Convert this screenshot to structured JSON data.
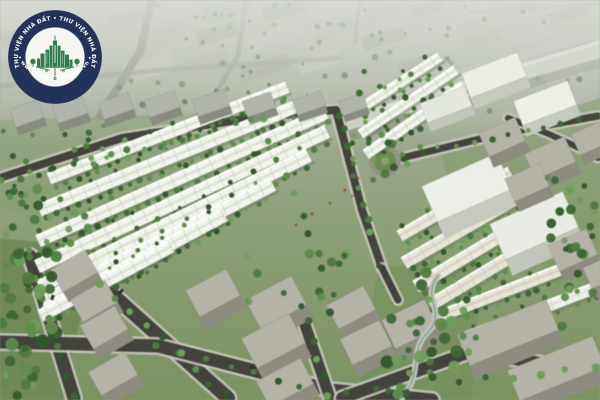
{
  "meta": {
    "width": 600,
    "height": 400,
    "alt": "Aerial 3D rendering of a residential master-planned neighborhood: rows of white townhouses with tree-lined streets, gray apartment blocks in a hazy background, an elevated road top-right, gray villa boxes and dark asphalt roads in the foreground"
  },
  "watermark": {
    "ring_text_top": "THƯ VIỆN NHÀ ĐẤT • THƯ VIỆN NHÀ ĐẤT",
    "ring_text_bottom": "• www.ThuVienNhaDat.vn •",
    "colors": {
      "ring": "#243158",
      "text": "#ffffff",
      "inner_disc": "#f5f6f2",
      "emblem_green": "#2e7b4e"
    }
  },
  "scene": {
    "seed": 1337,
    "palette_notes": {
      "haze_top": "#b4b8ae",
      "grass": "#7b925f",
      "asphalt": "#43423d",
      "sidewalk": "#c8c5b9",
      "townhouse_white": "#f2f4ed",
      "townhouse_beige": "#e8e5d6"
    },
    "palettes": [
      [
        "#3d6833",
        "#4e7b3e",
        "#5f8d4a",
        "#6f9e58",
        "#33572a"
      ],
      [
        "#4a6042",
        "#566f4c",
        "#415939",
        "#5d7850"
      ]
    ],
    "shapes": [
      [
        "rect",
        155,
        2,
        40,
        15,
        "#b6bab0",
        -15
      ],
      [
        "rect",
        203,
        0,
        50,
        17,
        "#a8aca1",
        -15
      ],
      [
        "rect",
        262,
        3,
        44,
        14,
        "#9da295",
        -15
      ],
      [
        "rect",
        316,
        0,
        42,
        15,
        "#b6bab0",
        -15
      ],
      [
        "rect",
        366,
        5,
        38,
        13,
        "#a8aca1",
        -15
      ],
      [
        "rect",
        412,
        2,
        32,
        12,
        "#9da295",
        -15
      ],
      [
        "rect",
        452,
        7,
        40,
        12,
        "#b6bab0",
        -15
      ],
      [
        "rect",
        500,
        3,
        36,
        12,
        "#a8aca1",
        -15
      ],
      [
        "rect",
        548,
        8,
        42,
        12,
        "#9da295",
        -15
      ],
      [
        "rect",
        140,
        28,
        46,
        17,
        "#a8aca1",
        -16
      ],
      [
        "rect",
        196,
        26,
        42,
        15,
        "#9da295",
        -16
      ],
      [
        "rect",
        248,
        30,
        54,
        15,
        "#b6bab0",
        -16
      ],
      [
        "rect",
        312,
        24,
        42,
        14,
        "#a8aca1",
        -16
      ],
      [
        "rect",
        362,
        32,
        44,
        13,
        "#9da295",
        -16
      ],
      [
        "rect",
        414,
        28,
        38,
        12,
        "#b6bab0",
        -16
      ],
      [
        "rect",
        462,
        34,
        40,
        12,
        "#a8aca1",
        -16
      ],
      [
        "rect",
        512,
        30,
        38,
        12,
        "#b6bab0",
        -16
      ],
      [
        "rect",
        558,
        36,
        36,
        12,
        "#9da295",
        -16
      ],
      [
        "rect",
        124,
        58,
        50,
        19,
        "#b6bab0",
        -17
      ],
      [
        "rect",
        184,
        54,
        46,
        17,
        "#a8aca1",
        -17
      ],
      [
        "rect",
        240,
        60,
        50,
        15,
        "#9da295",
        -17
      ],
      [
        "rect",
        298,
        54,
        42,
        15,
        "#b6bab0",
        -17
      ],
      [
        "rect",
        348,
        62,
        42,
        13,
        "#a8aca1",
        -17
      ],
      [
        "rect",
        398,
        58,
        36,
        12,
        "#9da295",
        -17
      ],
      [
        "rect",
        544,
        66,
        40,
        13,
        "#b6bab0",
        -17
      ],
      [
        "rect",
        560,
        84,
        38,
        15,
        "#a8aca1",
        -18
      ],
      [
        "rect",
        0,
        58,
        40,
        16,
        "#a8aca1",
        -19
      ],
      [
        "rect",
        0,
        28,
        36,
        15,
        "#9da295",
        -17
      ],
      [
        "rect",
        108,
        12,
        40,
        14,
        "#a8aca1",
        -16
      ],
      [
        "path",
        "M152,0 L140,52 L100,116",
        "#878b80",
        8
      ],
      [
        "path",
        "M246,0 L238,56 L214,96",
        "#878b80",
        5,
        0.7
      ],
      [
        "path",
        "M0,86 L160,70 L340,58",
        "#8d9186",
        5,
        0.6
      ],
      [
        "path",
        "M360,0 L355,42",
        "#878b80",
        4,
        0.6
      ],
      [
        "path",
        "M470,12 L600,4",
        "#8d9186",
        4,
        0.5
      ],
      [
        "tp",
        130,
        4,
        460,
        52,
        40,
        1.5,
        3,
        1,
        0.75
      ],
      [
        "tp",
        110,
        56,
        480,
        56,
        36,
        1.5,
        3.5,
        1,
        0.8
      ],
      [
        "poly",
        [
          [
            368,
            96
          ],
          [
            600,
            28
          ],
          [
            600,
            38
          ],
          [
            372,
            104
          ]
        ],
        "#b3b7ad"
      ],
      [
        "poly",
        [
          [
            344,
            132
          ],
          [
            600,
            58
          ],
          [
            600,
            68
          ],
          [
            350,
            141
          ]
        ],
        "#767b6e",
        0.45
      ],
      [
        "poly",
        [
          [
            334,
            120
          ],
          [
            600,
            40
          ],
          [
            600,
            58
          ],
          [
            342,
            132
          ]
        ],
        "#c8ccc1"
      ],
      [
        "poly",
        [
          [
            334,
            120
          ],
          [
            600,
            40
          ],
          [
            600,
            44
          ],
          [
            336,
            123
          ]
        ],
        "#dde0d6"
      ],
      [
        "car",
        488,
        96,
        6,
        3,
        -20,
        "#d8dad2"
      ],
      [
        "rect",
        0,
        0,
        600,
        150,
        "url(#haze)"
      ],
      [
        "poly",
        [
          [
            0,
            238
          ],
          [
            96,
            248
          ],
          [
            62,
            400
          ],
          [
            0,
            400
          ]
        ],
        "#6d8752",
        0.85
      ],
      [
        "poly",
        [
          [
            378,
            268
          ],
          [
            482,
            258
          ],
          [
            472,
            400
          ],
          [
            358,
            400
          ]
        ],
        "#74905a",
        0.7
      ],
      [
        "poly",
        [
          [
            440,
            150
          ],
          [
            600,
            98
          ],
          [
            600,
            300
          ],
          [
            470,
            262
          ]
        ],
        "#7e9a64",
        0.5
      ],
      [
        "poly",
        [
          [
            0,
            120
          ],
          [
            260,
            112
          ],
          [
            120,
            220
          ],
          [
            0,
            210
          ]
        ],
        "#7f9a66",
        0.35
      ],
      [
        "road",
        "M0,178 L122,138 L258,117",
        8
      ],
      [
        "road",
        "M256,117 L336,110 L362,210 L382,268",
        8
      ],
      [
        "road",
        "M30,256 L74,398",
        13
      ],
      [
        "road",
        "M96,280 L228,398",
        14
      ],
      [
        "road",
        "M0,342 L158,346 L330,390 L432,400",
        13
      ],
      [
        "road",
        "M302,316 L330,398",
        11
      ],
      [
        "road",
        "M342,398 L470,352 L598,372",
        12
      ],
      [
        "road",
        "M402,158 L500,134 L598,116",
        7
      ],
      [
        "road",
        "M508,118 Q558,136 598,158",
        6
      ],
      [
        "road",
        "M382,268 L398,300",
        7
      ],
      [
        "c",
        385,
        161,
        16,
        "#90947f"
      ],
      [
        "c",
        385,
        161,
        11,
        "#6d8a50"
      ],
      [
        "c",
        385,
        161,
        4,
        "#85a268"
      ],
      [
        "row",
        168,
        133,
        255,
        12,
        -21
      ],
      [
        "row",
        176,
        155,
        295,
        13,
        -22
      ],
      [
        "row",
        182,
        177,
        315,
        13,
        -24
      ],
      [
        "row",
        182,
        199,
        320,
        14,
        -25
      ],
      [
        "row",
        174,
        221,
        300,
        14,
        -26
      ],
      [
        "row",
        158,
        243,
        258,
        14,
        -27
      ],
      [
        "row",
        134,
        263,
        205,
        14,
        -28
      ],
      [
        "row",
        106,
        281,
        148,
        13,
        -28
      ],
      [
        "row",
        398,
        84,
        100,
        10,
        -33
      ],
      [
        "row",
        408,
        102,
        115,
        10,
        -34
      ],
      [
        "row",
        415,
        120,
        120,
        11,
        -35
      ],
      [
        "row",
        455,
        204,
        128,
        12,
        -30,
        "#eae8da",
        "#d6d2be"
      ],
      [
        "row",
        468,
        226,
        148,
        13,
        -30,
        "#e7e5d6",
        "#d6d2be"
      ],
      [
        "row",
        480,
        248,
        150,
        13,
        -31,
        "#eae8da",
        "#d6d2be"
      ],
      [
        "row",
        490,
        269,
        140,
        13,
        -31,
        "#e5e3d4",
        "#d6d2be"
      ],
      [
        "row",
        505,
        291,
        168,
        12,
        -21,
        "#e8e5d6",
        "#d5d1bd"
      ],
      [
        "row",
        532,
        312,
        140,
        12,
        -21,
        "#f0efe7",
        "#dde2d3"
      ],
      [
        "box",
        12,
        104,
        30,
        19,
        -19,
        "#b0b4aa",
        "#888c82"
      ],
      [
        "box",
        54,
        100,
        32,
        19,
        -19,
        "#b0b4aa",
        "#888c82"
      ],
      [
        "box",
        100,
        97,
        32,
        18,
        -19,
        "#b0b4aa",
        "#888c82"
      ],
      [
        "box",
        146,
        95,
        32,
        18,
        -19,
        "#b0b4aa",
        "#888c82"
      ],
      [
        "box",
        194,
        94,
        34,
        18,
        -19,
        "#b0b4aa",
        "#888c82"
      ],
      [
        "box",
        244,
        96,
        30,
        17,
        -19,
        "#b0b4aa",
        "#888c82"
      ],
      [
        "box",
        294,
        95,
        30,
        16,
        -19,
        "#b0b4aa",
        "#888c82"
      ],
      [
        "box",
        340,
        97,
        26,
        15,
        -19,
        "#b0b4aa",
        "#888c82"
      ],
      [
        "box",
        464,
        62,
        60,
        26,
        -21,
        "#eceee6",
        "#c6cabe"
      ],
      [
        "box",
        516,
        90,
        58,
        26,
        -21,
        "#eef0e8",
        "#c6cabe"
      ],
      [
        "box",
        422,
        94,
        48,
        21,
        -21,
        "#e4e7de",
        "#c2c6ba"
      ],
      [
        "box",
        426,
        168,
        82,
        39,
        -24,
        "#ecefe7",
        "#c6cabe"
      ],
      [
        "box",
        494,
        206,
        80,
        39,
        -24,
        "#e9ece4",
        "#c2c6ba"
      ],
      [
        "box",
        54,
        258,
        40,
        26,
        -30
      ],
      [
        "box",
        74,
        288,
        40,
        26,
        -30
      ],
      [
        "box",
        84,
        314,
        40,
        27,
        -30
      ],
      [
        "box",
        92,
        360,
        42,
        27,
        -30
      ],
      [
        "box",
        190,
        278,
        46,
        30,
        -28
      ],
      [
        "box",
        250,
        286,
        52,
        33,
        -28
      ],
      [
        "box",
        246,
        324,
        54,
        34,
        -28
      ],
      [
        "box",
        260,
        368,
        50,
        29,
        -28
      ],
      [
        "box",
        330,
        294,
        42,
        27,
        -28
      ],
      [
        "box",
        344,
        328,
        44,
        29,
        -26
      ],
      [
        "box",
        386,
        308,
        48,
        32,
        -26
      ],
      [
        "box",
        482,
        124,
        40,
        26,
        -24
      ],
      [
        "box",
        528,
        144,
        44,
        28,
        -24
      ],
      [
        "box",
        574,
        126,
        36,
        23,
        -24
      ],
      [
        "box",
        508,
        170,
        38,
        25,
        -24
      ],
      [
        "box",
        552,
        236,
        42,
        28,
        -24
      ],
      [
        "box",
        586,
        260,
        34,
        23,
        -24
      ],
      [
        "box",
        460,
        316,
        96,
        33,
        -22
      ],
      [
        "box",
        510,
        352,
        92,
        33,
        -22
      ],
      [
        "path",
        "M438,276 C420,298 448,312 428,332 C408,352 424,372 402,398",
        "#c2c7c0",
        6
      ],
      [
        "path",
        "M438,276 C420,298 448,312 428,332 C408,352 424,372 402,398",
        "#8aa089",
        2,
        0.8
      ],
      [
        "car",
        118,
        290,
        6,
        3,
        -42
      ],
      [
        "car",
        50,
        296,
        5,
        3,
        -74
      ],
      [
        "car",
        250,
        366,
        6,
        3,
        10
      ],
      [
        "tl",
        2,
        182,
        252,
        121,
        15,
        3
      ],
      [
        "tl",
        262,
        120,
        318,
        252,
        8,
        3
      ],
      [
        "tl",
        340,
        114,
        378,
        264,
        11,
        3
      ],
      [
        "tl",
        30,
        258,
        72,
        396,
        8,
        3.5
      ],
      [
        "tl",
        98,
        282,
        226,
        396,
        9,
        3.5
      ],
      [
        "tl",
        158,
        348,
        300,
        386,
        7,
        3
      ],
      [
        "tl",
        308,
        322,
        326,
        396,
        5,
        3.5
      ],
      [
        "tl",
        348,
        394,
        594,
        368,
        10,
        3.5
      ],
      [
        "tl",
        404,
        156,
        596,
        118,
        12,
        2.5
      ],
      [
        "tp",
        0,
        250,
        58,
        150,
        46,
        3,
        7,
        0
      ],
      [
        "tp",
        0,
        188,
        90,
        64,
        20,
        2.5,
        5,
        0
      ],
      [
        "tp",
        385,
        272,
        92,
        126,
        34,
        3,
        6.5,
        0
      ],
      [
        "tp",
        545,
        175,
        55,
        70,
        14,
        2.5,
        5,
        0
      ],
      [
        "tp",
        352,
        130,
        70,
        55,
        12,
        2,
        4.5,
        0
      ],
      [
        "tp",
        556,
        243,
        44,
        86,
        12,
        2.5,
        5,
        0
      ],
      [
        "tp",
        62,
        116,
        58,
        62,
        10,
        2,
        4,
        0
      ],
      [
        "tp",
        228,
        253,
        124,
        62,
        16,
        2.5,
        5,
        0
      ],
      [
        "tp",
        0,
        128,
        40,
        72,
        10,
        2,
        4,
        0
      ],
      [
        "tp",
        355,
        58,
        60,
        40,
        8,
        2,
        3.5,
        0
      ],
      [
        "c",
        345,
        190,
        1.6,
        "#a8543a"
      ],
      [
        "c",
        330,
        203,
        1.4,
        "#a8543a"
      ],
      [
        "c",
        312,
        214,
        1.5,
        "#9c4f36"
      ],
      [
        "c",
        358,
        178,
        1.4,
        "#a8543a"
      ],
      [
        "c",
        296,
        225,
        1.3,
        "#9c4f36"
      ],
      [
        "c",
        352,
        196,
        1.3,
        "#b06040"
      ]
    ]
  }
}
